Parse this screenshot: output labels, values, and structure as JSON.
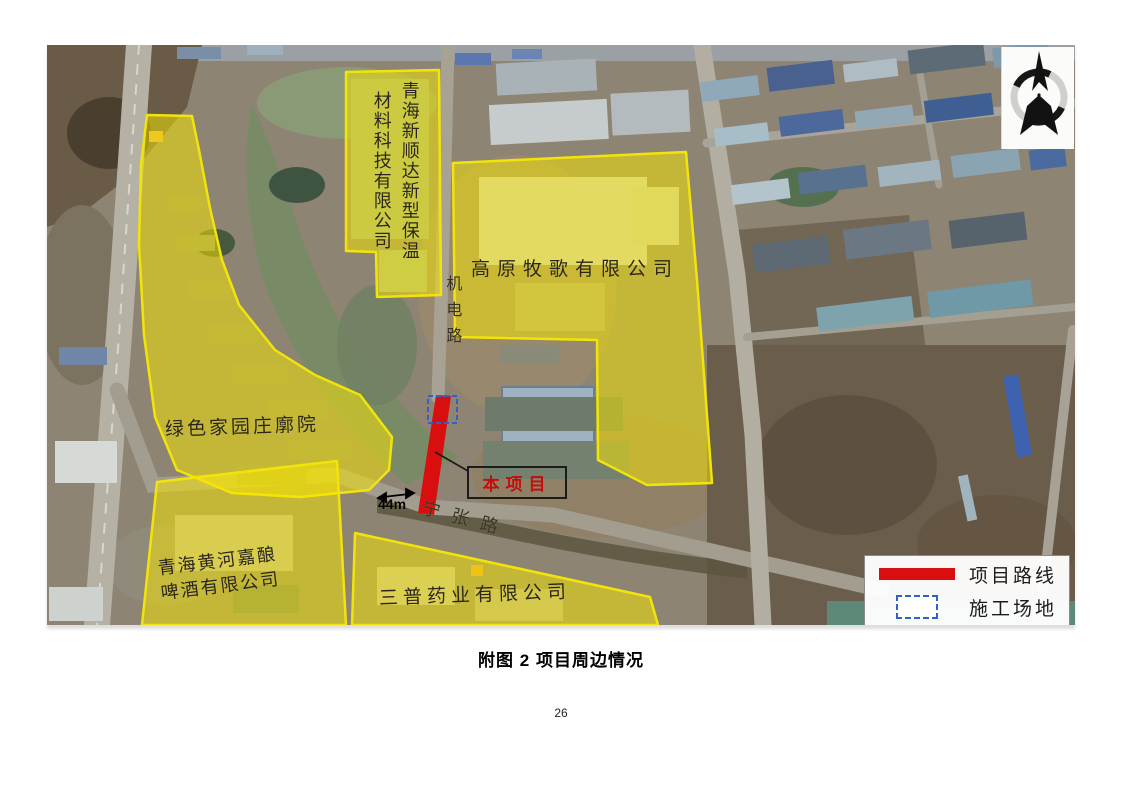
{
  "document": {
    "figure_caption": "附图 2  项目周边情况",
    "page_number": "26"
  },
  "map": {
    "areas": [
      {
        "id": "green-home",
        "name": "绿色家园庄廓院"
      },
      {
        "id": "xinshunda",
        "name": "青海新顺达新型保温材料科技有限公司",
        "name_columns": [
          "青海新顺达新型保温",
          "材料科技有限公司"
        ]
      },
      {
        "id": "gaoyuan-muge",
        "name": "高原牧歌有限公司"
      },
      {
        "id": "huanghe-beer",
        "name": "青海黄河嘉酿啤酒有限公司",
        "name_lines": [
          "青海黄河嘉酿",
          "啤酒有限公司"
        ]
      },
      {
        "id": "sanpu-pharma",
        "name": "三普药业有限公司"
      }
    ],
    "roads": [
      {
        "id": "jidian-road",
        "name": "机电路",
        "orientation": "vertical"
      },
      {
        "id": "ningzhang-road",
        "name": "宁张路",
        "orientation": "diagonal"
      }
    ],
    "annotations": {
      "project_box_label": "本项目",
      "distance_label": "44m"
    },
    "legend": {
      "items": [
        {
          "symbol": "route-line",
          "label": "项目路线",
          "color": "#d90f0f"
        },
        {
          "symbol": "construction-site-box",
          "label": "施工场地",
          "color": "#2f62c8"
        }
      ]
    },
    "colors": {
      "highlight_fill": "#f7e702",
      "route_red": "#d90f0f",
      "construction_blue": "#2f62c8"
    }
  }
}
